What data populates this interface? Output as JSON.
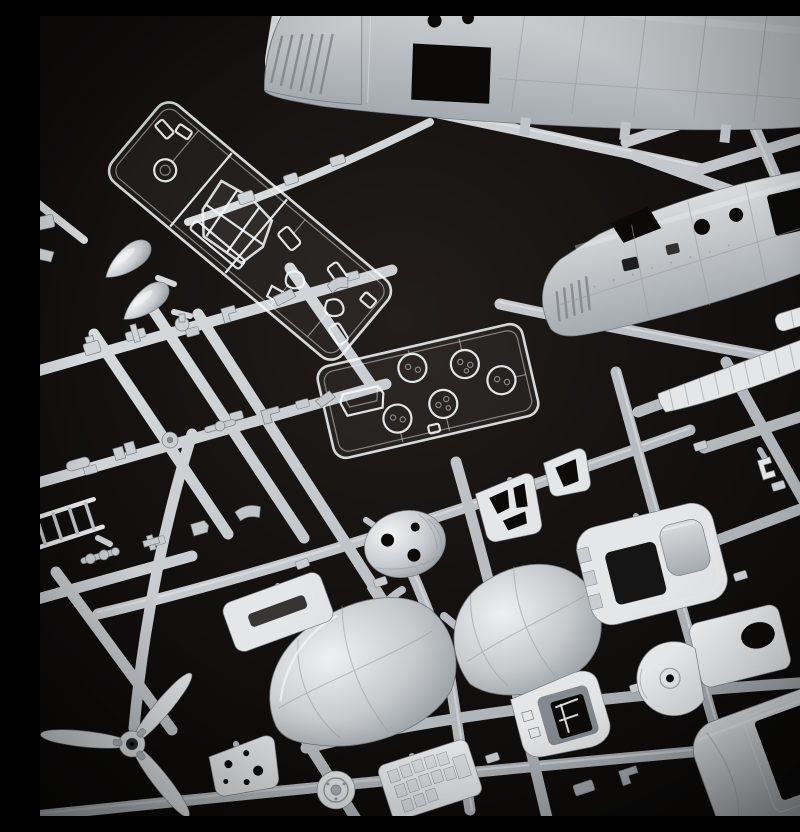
{
  "scene": {
    "type": "photograph",
    "subject": "Close-up studio photo of an injection-moulded plastic scale-model kit: light grey and transparent styrene sprues (part trees) for a helicopter model laid diagonally on a black background",
    "lighting": "soft light from upper left, dark vignette toward the corners",
    "palette": {
      "background": "#100e0d",
      "background_highlight": "#1d1917",
      "plastic_grey_light": "#e8eaec",
      "plastic_grey_mid": "#bfc4c8",
      "plastic_grey_shadow": "#8b9095",
      "clear_plastic_edge": "#f4f6f8",
      "cutout_shadow": "#0b0a09"
    },
    "objects": [
      {
        "name": "fuselage-half-top",
        "description": "Large grey fuselage half with louvered nose, dark cabin-door opening and two round portholes, clipped by the top edge"
      },
      {
        "name": "fuselage-half-middle",
        "description": "Second fuselage half with engine louvres, windscreen and door cut-outs and two portholes, running to the right edge"
      },
      {
        "name": "clear-canopy-sprue",
        "description": "Long transparent sprue holding a cockpit canopy, a ring and many small window panes"
      },
      {
        "name": "clear-lamp-sprue",
        "description": "Small transparent sprue with five round lamp lenses and a windscreen trough piece"
      },
      {
        "name": "main-rotor",
        "description": "Three-blade rotor with central hub, lower left corner"
      },
      {
        "name": "nose-cowling-halves",
        "description": "Two large silver nose-cowling halves flanking a sprue runner, bottom centre"
      },
      {
        "name": "gearbox-dome",
        "description": "Domed housing pierced with three holes"
      },
      {
        "name": "cockpit-tub",
        "description": "Cabin roof moulding with rectangular opening and seat hump"
      },
      {
        "name": "cabin-door",
        "description": "Door panel with oval window opening"
      },
      {
        "name": "bulkhead-disc",
        "description": "Round bulkhead disc with centre hole and flattened edge"
      },
      {
        "name": "instrument-panel",
        "description": "Instrument panel with recessed dark console"
      },
      {
        "name": "fuselage-side-panel",
        "description": "Large side panel with sliding-door opening, bottom right corner"
      },
      {
        "name": "rotor-blade-flat",
        "description": "Flat ribbed blade pieces at the right edge"
      },
      {
        "name": "window-frames",
        "description": "Small window-frame pieces with dark cut-outs"
      },
      {
        "name": "spinner-cones",
        "description": "Two bullet-shaped cone pieces on the left"
      },
      {
        "name": "breaker-panel",
        "description": "Panel covered with a grid of raised squares"
      },
      {
        "name": "firewall-plate",
        "description": "Small plate pierced with holes"
      },
      {
        "name": "hatch-door",
        "description": "Small rectangular hatch with recessed slot"
      },
      {
        "name": "ladder-frame",
        "description": "Ladder-like frame at the left edge"
      },
      {
        "name": "sprue-runners",
        "description": "Criss-crossing grey runners with moulded part-number tags"
      },
      {
        "name": "junction-boss",
        "description": "Round moulded boss where runners cross"
      }
    ],
    "detail_note": "Dozens of small grey detail parts are attached along the runner lattice"
  }
}
